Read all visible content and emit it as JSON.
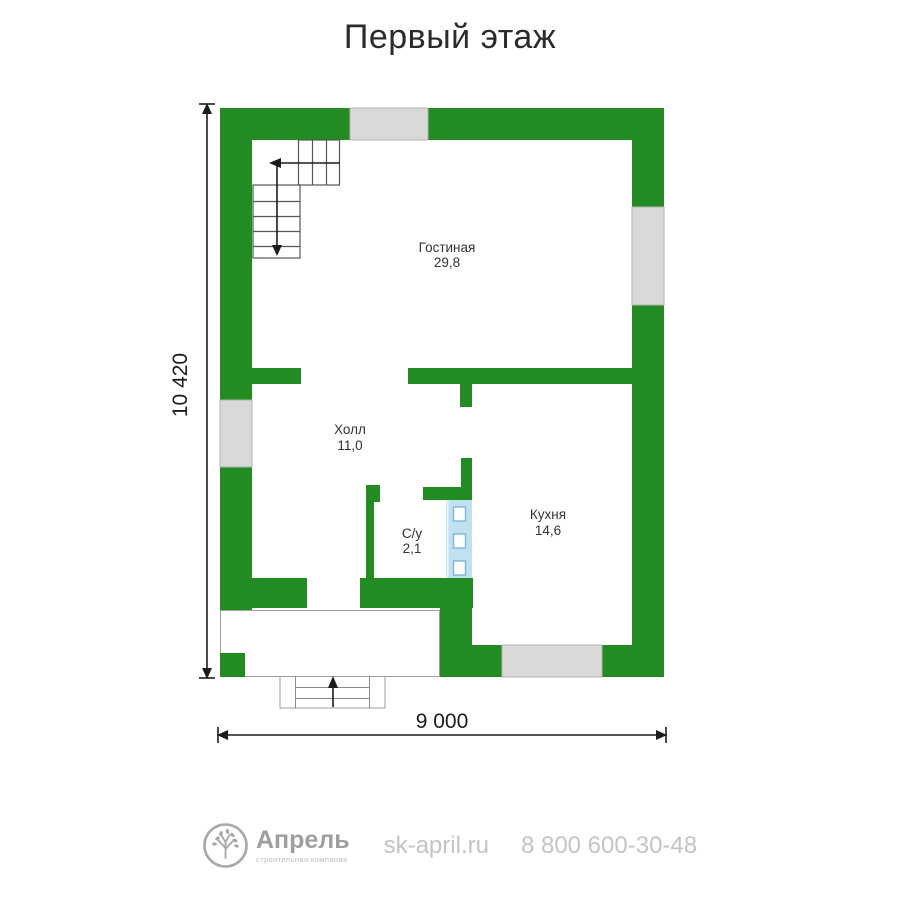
{
  "title": "Первый этаж",
  "plan": {
    "rooms": [
      {
        "name": "Гостиная",
        "area": "29,8"
      },
      {
        "name": "Холл",
        "area": "11,0"
      },
      {
        "name": "С/у",
        "area": "2,1"
      },
      {
        "name": "Кухня",
        "area": "14,6"
      }
    ],
    "dimensions": {
      "height": "10 420",
      "width": "9 000"
    }
  },
  "footer": {
    "brand": "Апрель",
    "tagline": "строительная компания",
    "website": "sk-april.ru",
    "phone": "8 800 600-30-48"
  },
  "colors": {
    "wall": "#228b22",
    "window": "#d9d9d9",
    "glass": "#bfe1f2",
    "glass-border": "#7fb4d4",
    "line": "#1c1c1c",
    "text": "#333333",
    "muted": "#9e9e9e",
    "muted-light": "#c4c4c4"
  }
}
